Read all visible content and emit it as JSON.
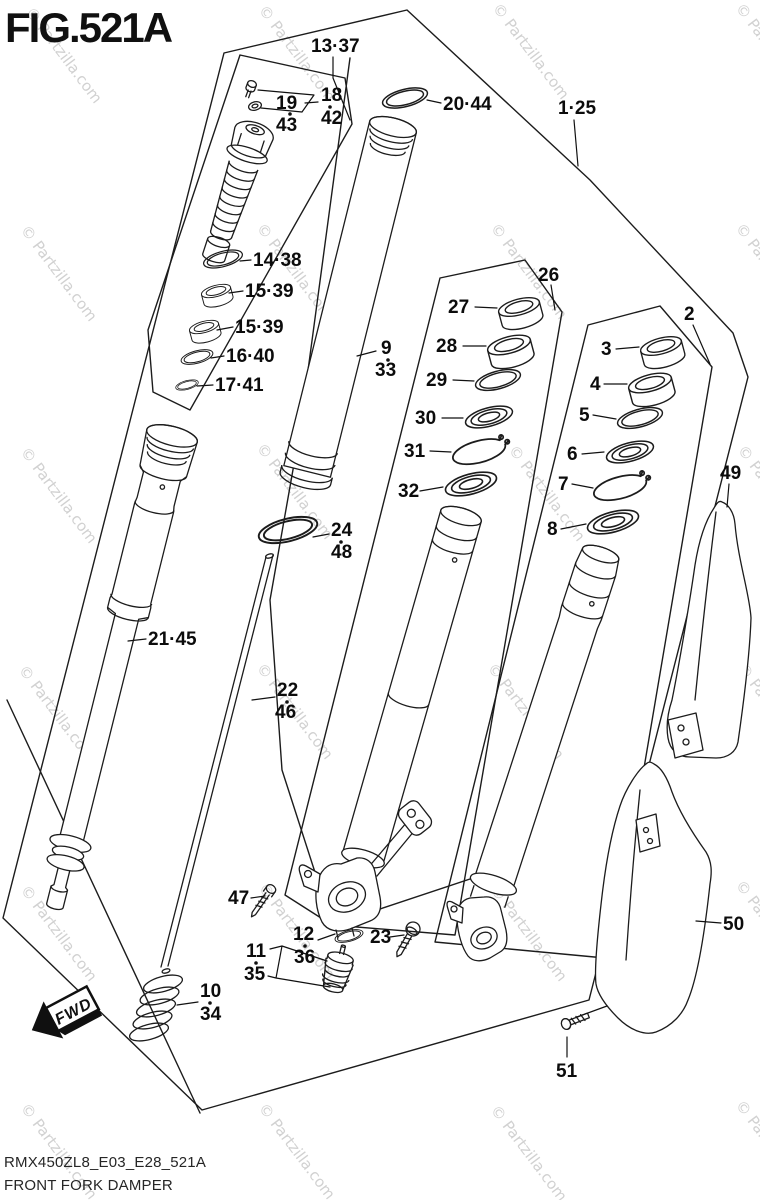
{
  "figure": {
    "title": "FIG.521A"
  },
  "watermark": {
    "text": "© Partzilla.com"
  },
  "footer": {
    "part_code": "RMX450ZL8_E03_E28_521A",
    "figure_name": "FRONT FORK DAMPER"
  },
  "direction_arrow": {
    "label": "FWD"
  },
  "callouts": {
    "c1_25": {
      "text": "1·25"
    },
    "c13_37": {
      "text": "13·37"
    },
    "c19_43": {
      "lines": [
        "19",
        "43"
      ]
    },
    "c18_42": {
      "lines": [
        "18",
        "42"
      ]
    },
    "c20_44": {
      "text": "20·44"
    },
    "c14_38": {
      "text": "14·38"
    },
    "c15_39a": {
      "text": "15·39"
    },
    "c15_39b": {
      "text": "15·39"
    },
    "c16_40": {
      "text": "16·40"
    },
    "c17_41": {
      "text": "17·41"
    },
    "c9_33": {
      "lines": [
        "9",
        "33"
      ]
    },
    "c24_48": {
      "lines": [
        "24",
        "48"
      ]
    },
    "c21_45": {
      "text": "21·45"
    },
    "c22_46": {
      "lines": [
        "22",
        "46"
      ]
    },
    "c10_34": {
      "lines": [
        "10",
        "34"
      ]
    },
    "c26": {
      "text": "26"
    },
    "c27": {
      "text": "27"
    },
    "c28": {
      "text": "28"
    },
    "c29": {
      "text": "29"
    },
    "c30": {
      "text": "30"
    },
    "c31": {
      "text": "31"
    },
    "c32": {
      "text": "32"
    },
    "c2": {
      "text": "2"
    },
    "c3": {
      "text": "3"
    },
    "c4": {
      "text": "4"
    },
    "c5": {
      "text": "5"
    },
    "c6": {
      "text": "6"
    },
    "c7": {
      "text": "7"
    },
    "c8": {
      "text": "8"
    },
    "c49": {
      "text": "49"
    },
    "c47": {
      "text": "47"
    },
    "c11_35": {
      "lines": [
        "11",
        "35"
      ]
    },
    "c12_36": {
      "lines": [
        "12",
        "36"
      ]
    },
    "c23": {
      "text": "23"
    },
    "c50": {
      "text": "50"
    },
    "c51": {
      "text": "51"
    }
  }
}
